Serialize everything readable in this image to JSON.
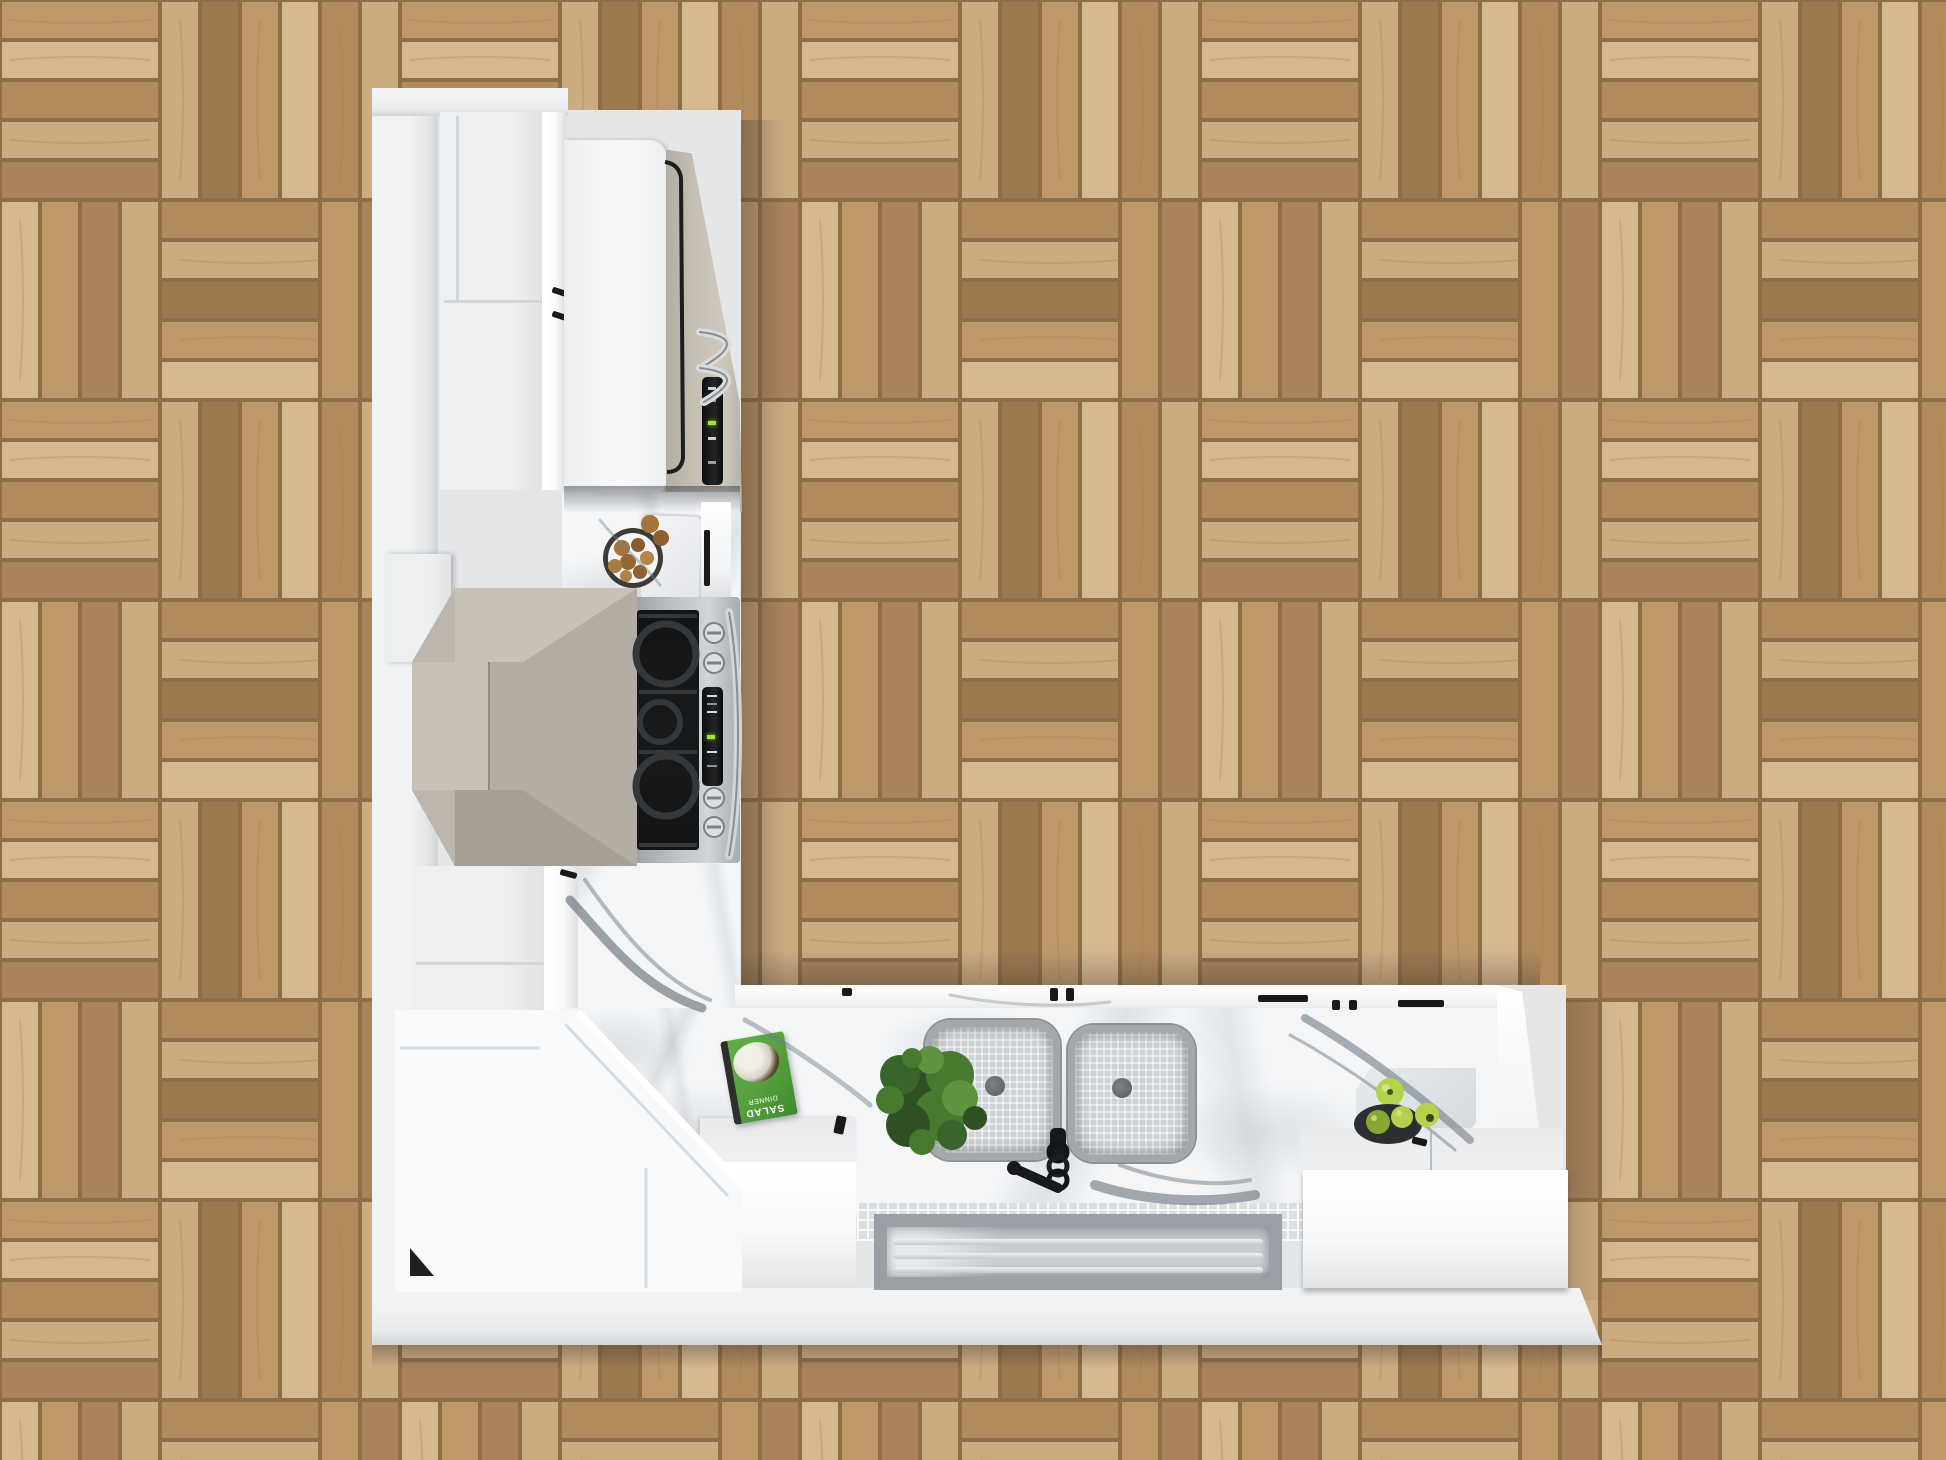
{
  "scene": {
    "description": "Top-down 3D render of an L-shaped white kitchen on herringbone oak parquet",
    "room": "kitchen",
    "view": "overhead plan render",
    "floor": "herringbone oak parquet",
    "objects": [
      {
        "label": "wall-and-plinth-platform"
      },
      {
        "label": "tall-pantry-cabinets"
      },
      {
        "label": "refrigerator"
      },
      {
        "label": "bowl-of-walnuts"
      },
      {
        "label": "marble-cutting-board"
      },
      {
        "label": "range-hood"
      },
      {
        "label": "gas-cooktop-range"
      },
      {
        "label": "upper-wall-cabinets"
      },
      {
        "label": "corner-base-cabinets"
      },
      {
        "label": "double-basin-sink"
      },
      {
        "label": "black-coil-faucet"
      },
      {
        "label": "potted-plant"
      },
      {
        "label": "salad-cookbook"
      },
      {
        "label": "green-apples-with-bowl"
      },
      {
        "label": "white-storage-box"
      },
      {
        "label": "glass-front-panel"
      }
    ]
  },
  "book": {
    "title_line1": "SALAD",
    "title_line2": "DINNER"
  },
  "palette": {
    "wood-1": "#cfae83",
    "wood-2": "#c09a6d",
    "wood-3": "#b18a5c",
    "wood-4": "#9a754c",
    "wood-5": "#d8bb92",
    "wood-6": "#a8815a",
    "wood-gap": "#8a6a45",
    "wall": "#e4e6e8",
    "wall-bright": "#f0f2f3",
    "plinth": "#e9ebed",
    "cab": "#edeff1",
    "cab-bright": "#f8f9fa",
    "marble-base": "#f3f5f7",
    "vein": "#6f7d8a",
    "vein-dark": "#4e5a66",
    "hood-n": "#c7c1b7",
    "hood-e": "#b3ada3",
    "hood-s": "#a59f95",
    "hood-w": "#bcb6ac",
    "fridge-beige": "#c6bfb4",
    "steel": "#c0c3c6",
    "steel-dark": "#8e9194",
    "dark": "#17191b",
    "display-green": "#9fe03a",
    "sink-rim": "#a3a8ac",
    "sink-basin": "#ced2d5",
    "drain": "#62676b",
    "plant-1": "#2f5124",
    "plant-2": "#477a2e",
    "plant-3": "#5e9340",
    "plant-4": "#39642a",
    "apple": "#b4d24b",
    "apple-dark": "#86a832",
    "bowl": "#2c2f31",
    "book-green": "#55a03d",
    "glass-frame": "#9aa0a5",
    "glass": "#c9ced3",
    "tile": "#dcdfe1"
  }
}
